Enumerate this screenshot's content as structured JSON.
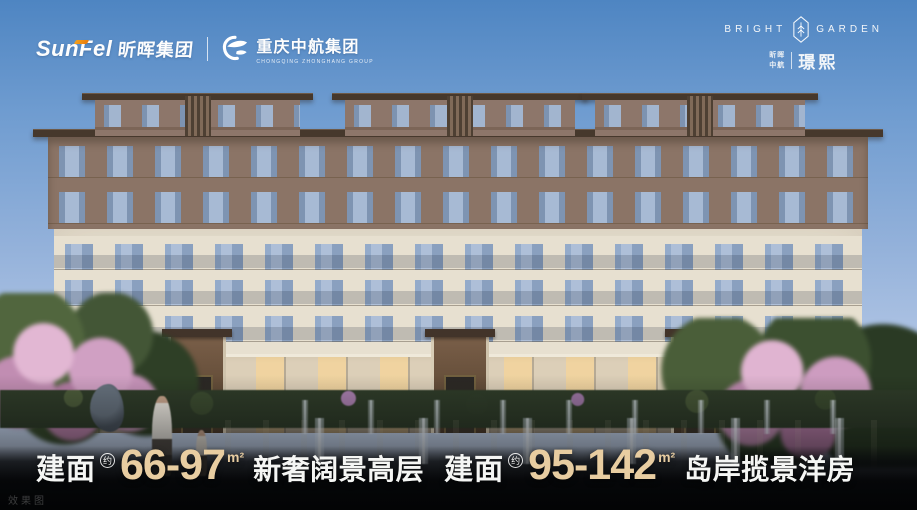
{
  "header": {
    "sunfel": {
      "latin": "SunFel",
      "cjk": "昕晖集团"
    },
    "partner": {
      "cjk": "重庆中航集团",
      "latin": "CHONGQING ZHONGHANG GROUP"
    },
    "project": {
      "word_left": "BRIGHT",
      "word_right": "GARDEN",
      "sub_line1": "昕晖",
      "sub_line2": "中航",
      "name": "璟熙"
    }
  },
  "headline": {
    "segments": [
      {
        "label": "建面",
        "approx": "约",
        "range": "66-97",
        "unit": "m²",
        "desc": "新奢阔景高层"
      },
      {
        "label": "建面",
        "approx": "约",
        "range": "95-142",
        "unit": "m²",
        "desc": "岛岸揽景洋房"
      }
    ]
  },
  "watermark": "效果图",
  "colors": {
    "accent_gold": "#e8cda1",
    "accent_orange": "#f08a14",
    "sky_top": "#4e85c2",
    "text_white": "#f5f6f4"
  }
}
